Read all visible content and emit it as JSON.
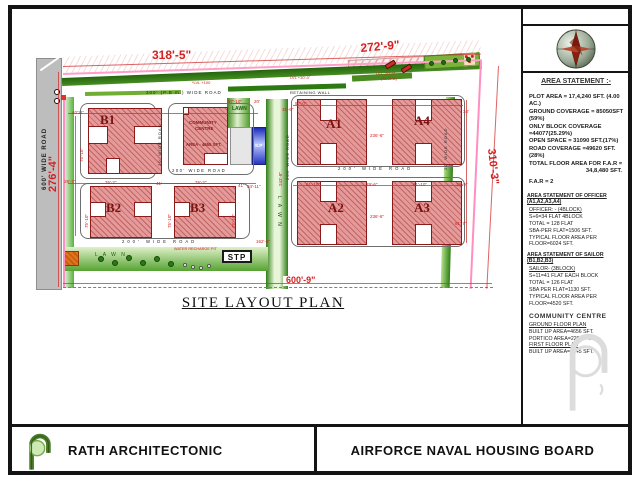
{
  "plan": {
    "title": "SITE LAYOUT PLAN",
    "stp_label": "STP",
    "sp_label": "S.P",
    "dim_bottom": "600'-9\"",
    "buildings": [
      {
        "t": "B1",
        "x": 88,
        "y": 108,
        "w": 74,
        "h": 66,
        "lx": 100,
        "ly": 112,
        "fs": 13
      },
      {
        "t": "B2",
        "x": 90,
        "y": 186,
        "w": 62,
        "h": 52,
        "lx": 106,
        "ly": 200,
        "fs": 13
      },
      {
        "t": "B3",
        "x": 174,
        "y": 186,
        "w": 62,
        "h": 52,
        "lx": 190,
        "ly": 200,
        "fs": 13
      },
      {
        "t": "A1",
        "x": 297,
        "y": 99,
        "w": 70,
        "h": 66,
        "lx": 326,
        "ly": 116,
        "fs": 13
      },
      {
        "t": "A4",
        "x": 392,
        "y": 99,
        "w": 70,
        "h": 66,
        "lx": 414,
        "ly": 113,
        "fs": 13
      },
      {
        "t": "A2",
        "x": 297,
        "y": 181,
        "w": 70,
        "h": 64,
        "lx": 328,
        "ly": 200,
        "fs": 13
      },
      {
        "t": "A3",
        "x": 392,
        "y": 181,
        "w": 70,
        "h": 64,
        "lx": 414,
        "ly": 200,
        "fs": 13
      },
      {
        "t": "",
        "x": 183,
        "y": 107,
        "w": 45,
        "h": 58
      }
    ],
    "cutouts": [
      [
        88,
        126,
        20,
        18
      ],
      [
        134,
        126,
        28,
        18
      ],
      [
        106,
        158,
        14,
        16
      ],
      [
        90,
        202,
        16,
        15
      ],
      [
        134,
        202,
        18,
        15
      ],
      [
        174,
        202,
        16,
        15
      ],
      [
        218,
        202,
        18,
        15
      ],
      [
        320,
        99,
        17,
        22
      ],
      [
        320,
        143,
        17,
        22
      ],
      [
        415,
        99,
        17,
        22
      ],
      [
        415,
        143,
        17,
        22
      ],
      [
        320,
        181,
        17,
        21
      ],
      [
        320,
        224,
        17,
        21
      ],
      [
        415,
        181,
        17,
        21
      ],
      [
        415,
        224,
        17,
        21
      ],
      [
        204,
        153,
        24,
        12
      ],
      [
        183,
        107,
        6,
        8
      ]
    ],
    "outlines": [
      [
        80,
        103,
        76,
        76
      ],
      [
        168,
        103,
        86,
        72
      ],
      [
        80,
        183,
        170,
        56
      ],
      [
        291,
        95,
        174,
        72
      ],
      [
        291,
        177,
        174,
        70
      ]
    ],
    "dimlines": [
      {
        "x": 63,
        "y": 66,
        "w": 418,
        "rot": -1.7
      },
      {
        "x": 63,
        "y": 283,
        "w": 429
      },
      {
        "x": 58,
        "y": 72,
        "h": 215
      },
      {
        "x": 498,
        "y": 66,
        "h": 223,
        "rot": 3
      },
      {
        "x": 68,
        "y": 113,
        "w": 190
      },
      {
        "x": 68,
        "y": 183,
        "w": 188
      },
      {
        "x": 293,
        "y": 105,
        "w": 170
      },
      {
        "x": 293,
        "y": 185,
        "w": 170
      },
      {
        "x": 466,
        "y": 100,
        "h": 143
      },
      {
        "x": 75,
        "y": 116,
        "h": 120
      }
    ],
    "labels": [
      {
        "t": "318'-5\"",
        "x": 152,
        "y": 49,
        "fs": 12,
        "c": "r",
        "b": 1,
        "n": "dim-top-left"
      },
      {
        "t": "272'-9\"",
        "x": 360,
        "y": 42,
        "fs": 12,
        "c": "r",
        "b": 1,
        "rot": -5,
        "n": "dim-top-right"
      },
      {
        "t": "276'-4\"",
        "x": 47,
        "y": 192,
        "fs": 11,
        "c": "r",
        "b": 1,
        "rot": -90,
        "n": "dim-left"
      },
      {
        "t": "310'-3\"",
        "x": 497,
        "y": 148,
        "fs": 11,
        "c": "r",
        "b": 1,
        "rot": 84,
        "n": "dim-right"
      },
      {
        "t": "40'11\"",
        "x": 72,
        "y": 111,
        "fs": 4.5,
        "c": "r"
      },
      {
        "t": "75'-10\"",
        "x": 80,
        "y": 162,
        "fs": 4.5,
        "c": "r",
        "rot": -90
      },
      {
        "t": "28'-7\"",
        "x": 64,
        "y": 180,
        "fs": 4.5,
        "c": "r"
      },
      {
        "t": "76'-2\"",
        "x": 105,
        "y": 181,
        "fs": 4.5,
        "c": "r"
      },
      {
        "t": "41'",
        "x": 156,
        "y": 182,
        "fs": 4.5,
        "c": "r"
      },
      {
        "t": "76'-2\"",
        "x": 195,
        "y": 181,
        "fs": 4.5,
        "c": "r"
      },
      {
        "t": "41'",
        "x": 238,
        "y": 184,
        "fs": 4.5,
        "c": "r"
      },
      {
        "t": "75'-10\"",
        "x": 85,
        "y": 228,
        "fs": 4.5,
        "c": "r",
        "rot": -90
      },
      {
        "t": "75'-10\"",
        "x": 168,
        "y": 228,
        "fs": 4.5,
        "c": "r",
        "rot": -90
      },
      {
        "t": "75'-10\"",
        "x": 232,
        "y": 228,
        "fs": 4.5,
        "c": "r",
        "rot": -90
      },
      {
        "t": "34'-11\"",
        "x": 247,
        "y": 185,
        "fs": 4.5,
        "c": "r"
      },
      {
        "t": "97'-10\"",
        "x": 228,
        "y": 100,
        "fs": 4.5,
        "c": "r"
      },
      {
        "t": "20'",
        "x": 254,
        "y": 100,
        "fs": 4.5,
        "c": "r"
      },
      {
        "t": "97'-0\"",
        "x": 295,
        "y": 102,
        "fs": 4.5,
        "c": "r"
      },
      {
        "t": "31'-6\"",
        "x": 282,
        "y": 108,
        "fs": 4.5,
        "c": "r"
      },
      {
        "t": "236'-6\"",
        "x": 370,
        "y": 134,
        "fs": 4.5,
        "c": "r"
      },
      {
        "t": "34'",
        "x": 463,
        "y": 110,
        "fs": 4.5,
        "c": "r"
      },
      {
        "t": "61'-10\"",
        "x": 306,
        "y": 183,
        "fs": 4.5,
        "c": "r"
      },
      {
        "t": "29'-6\"",
        "x": 366,
        "y": 183,
        "fs": 4.5,
        "c": "r"
      },
      {
        "t": "61'-10\"",
        "x": 413,
        "y": 183,
        "fs": 4.5,
        "c": "r"
      },
      {
        "t": "39'-9\"",
        "x": 456,
        "y": 183,
        "fs": 4.5,
        "c": "r"
      },
      {
        "t": "236'-6\"",
        "x": 370,
        "y": 215,
        "fs": 4.5,
        "c": "r"
      },
      {
        "t": "61'-7\"",
        "x": 455,
        "y": 222,
        "fs": 4.5,
        "c": "r"
      },
      {
        "t": "243'-8\"",
        "x": 279,
        "y": 186,
        "fs": 4.5,
        "c": "r",
        "rot": -90
      },
      {
        "t": "162'-6\"",
        "x": 256,
        "y": 240,
        "fs": 4.5,
        "c": "r"
      },
      {
        "t": "*LVL +100",
        "x": 192,
        "y": 81,
        "fs": 4,
        "c": "r"
      },
      {
        "t": "LVL +10'-0\"",
        "x": 290,
        "y": 76,
        "fs": 4,
        "c": "r"
      },
      {
        "t": "LVL -20'-0\"",
        "x": 376,
        "y": 72,
        "fs": 4,
        "c": "r"
      },
      {
        "t": "(SLOPE)",
        "x": 381,
        "y": 77,
        "fs": 4,
        "c": "r"
      },
      {
        "t": "WATER RECHARGE PIT",
        "x": 174,
        "y": 247,
        "fs": 3.8,
        "c": "r"
      },
      {
        "t": "300' (P.B m.) WIDE ROAD",
        "x": 146,
        "y": 91,
        "fs": 4.5,
        "c": "k",
        "ls": 1,
        "n": "road-label-top"
      },
      {
        "t": "RETAINING WALL",
        "x": 290,
        "y": 91,
        "fs": 4,
        "c": "k",
        "ls": 0.5
      },
      {
        "t": "20' WIDE ROAD",
        "x": 158,
        "y": 166,
        "fs": 4,
        "c": "k",
        "rot": -90,
        "ls": 1,
        "n": "road-label"
      },
      {
        "t": "200' WIDE ROAD",
        "x": 172,
        "y": 169,
        "fs": 4.2,
        "c": "k",
        "ls": 1.5,
        "n": "road-label"
      },
      {
        "t": "200' WIDE ROAD",
        "x": 286,
        "y": 180,
        "fs": 4,
        "c": "k",
        "rot": -90,
        "ls": 1,
        "n": "road-label"
      },
      {
        "t": "200' WIDE ROAD",
        "x": 338,
        "y": 167,
        "fs": 4.2,
        "c": "k",
        "ls": 3,
        "n": "road-label"
      },
      {
        "t": "200' WIDE ROAD",
        "x": 122,
        "y": 240,
        "fs": 4.2,
        "c": "k",
        "ls": 3,
        "n": "road-label"
      },
      {
        "t": "20' WIDE ROAD",
        "x": 444,
        "y": 170,
        "fs": 4,
        "c": "k",
        "rot": -90,
        "ls": 1,
        "n": "road-label"
      },
      {
        "t": "600' WIDE ROAD",
        "x": 42,
        "y": 190,
        "fs": 6,
        "c": "k",
        "rot": -90,
        "ls": 1,
        "b": 1,
        "n": "road-label-left"
      },
      {
        "t": "L A W N",
        "x": 95,
        "y": 253,
        "fs": 5,
        "c": "g",
        "ls": 2,
        "n": "lawn-label"
      },
      {
        "t": "LAWN",
        "x": 232,
        "y": 107,
        "fs": 5,
        "c": "g",
        "b": 1,
        "n": "lawn-label"
      },
      {
        "t": "L A W N",
        "x": 281,
        "y": 196,
        "fs": 5,
        "c": "g",
        "ls": 2,
        "rot": 90,
        "n": "lawn-label"
      },
      {
        "t": "COMMUNITY",
        "x": 189,
        "y": 121,
        "fs": 4.5,
        "c": "m",
        "b": 1,
        "n": "community-centre-label"
      },
      {
        "t": "CENTRE",
        "x": 195,
        "y": 127,
        "fs": 4.5,
        "c": "m",
        "b": 1,
        "n": "community-centre-label"
      },
      {
        "t": "AREA - 4655 SFT.",
        "x": 186,
        "y": 143,
        "fs": 4.3,
        "c": "m",
        "b": 1,
        "n": "community-centre-area"
      }
    ],
    "trees_bottom": [
      [
        98,
        256
      ],
      [
        112,
        260
      ],
      [
        126,
        255
      ],
      [
        140,
        260
      ],
      [
        154,
        256
      ],
      [
        168,
        261
      ]
    ],
    "trees_top": [
      [
        429,
        61
      ],
      [
        441,
        60
      ],
      [
        453,
        58
      ],
      [
        466,
        57
      ]
    ],
    "pits": [
      [
        183,
        263
      ],
      [
        191,
        265
      ],
      [
        199,
        266
      ],
      [
        207,
        264
      ]
    ],
    "cars": [
      [
        385,
        62
      ],
      [
        401,
        66
      ]
    ]
  },
  "panel": {
    "heading": "AREA STATEMENT :-",
    "stats": [
      "PLOT AREA = 17,4,240 SFT. (4.00 AC.)",
      "GROUND COVERAGE = 85050SFT (59%)",
      "ONLY BLOCK COVERAGE =44077(25.29%)",
      "OPEN SPACE = 31090 SFT.(17%)",
      "ROAD COVERAGE =49620 SFT.(28%)",
      "TOTAL FLOOR AREA FOR F.A.R =",
      {
        "t": "34,8,480 SFT.",
        "cls": "ta-r"
      },
      {
        "t": "F.A.R = 2",
        "cls": "mt"
      }
    ],
    "officer_heading": "AREA STATEMENT OF OFFICER (A1,A2,A3,A4)",
    "officer_lines": [
      {
        "t": "OFFICER: - (4BLOCK)",
        "u": 1
      },
      {
        "t": "S+6=34 FLAT 4BLOCK"
      },
      {
        "t": "TOTAL = 128 FLAT"
      },
      {
        "t": "SBA-PER FLAT=1506 SFT."
      },
      {
        "t": "TYPICAL FLOOR AREA PER FLOOR=6024 SFT."
      }
    ],
    "sailor_heading": "AREA STATEMENT OF SAILOR (B1,B2,B3)",
    "sailor_lines": [
      {
        "t": "SAILOR- (3BLOCK)",
        "u": 1
      },
      {
        "t": "S+11=41 FLAT EACH BLOCK"
      },
      {
        "t": "TOTAL = 126 FLAT"
      },
      {
        "t": "SBA PER FLAT=1130 SFT."
      },
      {
        "t": "TYPICAL FLOOR AREA PER FLOOR=4520 SFT."
      }
    ],
    "community_heading": "COMMUNITY CENTRE",
    "community_lines": [
      {
        "t": "GROUND FLOOR PLAN",
        "u": 1
      },
      {
        "t": "BUILT UP AREA=4656 SFT."
      },
      {
        "t": "PORTICO AREA=220 SFT."
      },
      {
        "t": "FIRST FLOOR PLAN",
        "u": 1
      },
      {
        "t": "BUILT UP AREA=2345 SFT."
      }
    ]
  },
  "footer": {
    "firm": "RATH ARCHITECTONIC",
    "project": "AIRFORCE NAVAL HOUSING BOARD"
  },
  "colors": {
    "building_fill": "#e59a9a",
    "building_border": "#8b1a1a",
    "dimension_red": "#d22222",
    "boundary_magenta": "#f23da5",
    "lawn_green": "#2f7d15",
    "road_gray": "#bdbdbd",
    "pool_blue": "#1b2bb8"
  }
}
